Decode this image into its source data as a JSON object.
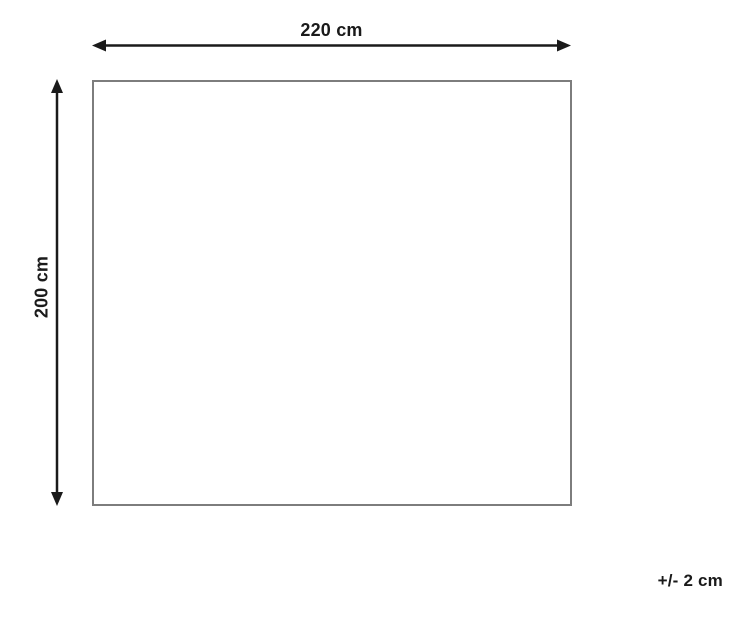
{
  "diagram": {
    "type": "product-dimension-diagram",
    "width_label": "220 cm",
    "height_label": "200 cm",
    "tolerance_label": "+/- 2 cm"
  },
  "colors": {
    "background": "#ffffff",
    "arrow": "#1a1a1a",
    "text": "#1a1a1a",
    "rectangle_border": "#7d7d7d"
  }
}
